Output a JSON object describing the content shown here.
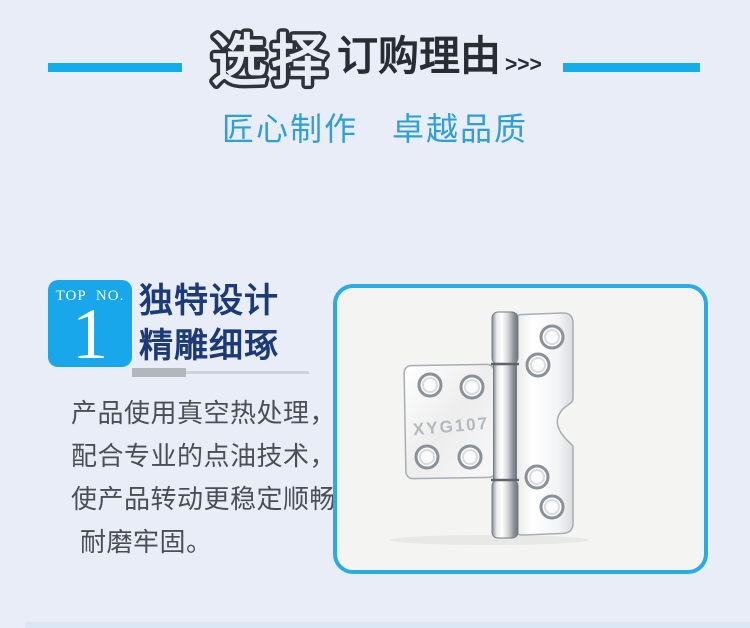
{
  "page": {
    "background": "#E8EDF8",
    "footer_strip_color": "#DBE7F5"
  },
  "header": {
    "bubble_title": "选择",
    "main_title": "订购理由",
    "arrows": ">>>",
    "accent_bar_color": "#12AEEC",
    "title_color": "#282C33"
  },
  "subtitle": {
    "text": "匠心制作　卓越品质",
    "color": "#2E9FD8"
  },
  "feature": {
    "badge": {
      "label": "TOP NO.",
      "number": "1",
      "background": "#17A7EA",
      "text_color": "#FFFFFF"
    },
    "heading": {
      "line1": "独特设计",
      "line2": "精雕细琢",
      "color": "#1C3A78"
    },
    "description": {
      "lines": [
        "产品使用真空热处理，",
        "配合专业的点油技术，",
        "使产品转动更稳定顺畅",
        "耐磨牢固。"
      ],
      "color": "#4B4E53"
    }
  },
  "product": {
    "engraving": "XYG107",
    "frame_border_color": "#29ACE3",
    "frame_background": "#F4F4F2"
  }
}
